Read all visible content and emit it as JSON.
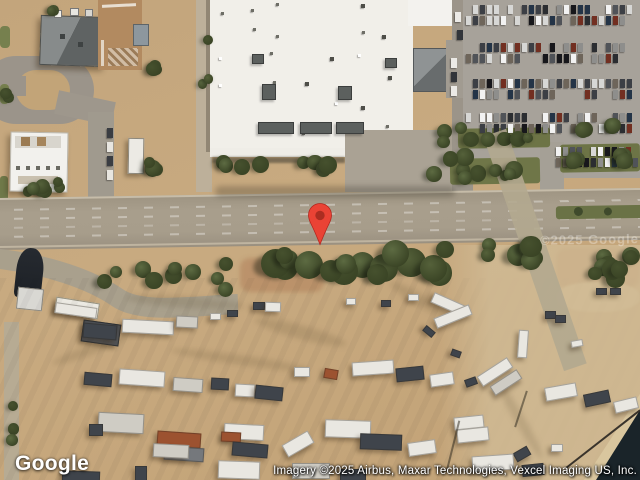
{
  "map_overlay": {
    "logo_text": "Google",
    "attribution_text": "Imagery ©2025 Airbus, Maxar Technologies, Vexcel Imaging US, Inc.",
    "imagery_watermark_text": "©2025 Google"
  },
  "marker": {
    "icon": "location-pin",
    "color": "#EA4335",
    "inner_dot_color": "#AB2D21"
  },
  "palette": {
    "dirt": "#c6a87d",
    "road": "#a49a88",
    "parking_pavement": "#a7a29a",
    "warehouse_roof": "#f1efe9",
    "tree_canopy": "#49552f",
    "grass": "#6f7648",
    "water": "#1c262b",
    "rust_dirt": "#96542f"
  }
}
